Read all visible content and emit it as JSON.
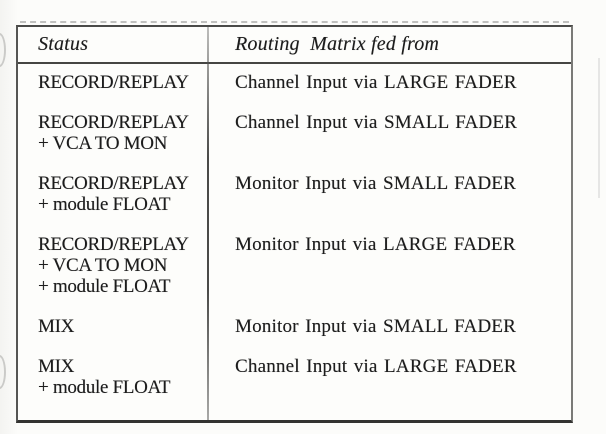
{
  "document": {
    "kind": "scanned-manual-table",
    "table": {
      "headers": {
        "status": "Status",
        "routing": "Routing  Matrix fed from"
      },
      "rows": [
        {
          "status": "RECORD/REPLAY",
          "routing": "Channel Input via LARGE FADER"
        },
        {
          "status": "RECORD/REPLAY\n+ VCA TO MON",
          "routing": "Channel Input via SMALL FADER"
        },
        {
          "status": "RECORD/REPLAY\n+ module FLOAT",
          "routing": "Monitor Input via SMALL FADER"
        },
        {
          "status": "RECORD/REPLAY\n+ VCA TO MON\n+ module FLOAT",
          "routing": "Monitor Input via LARGE FADER"
        },
        {
          "status": "MIX",
          "routing": "Monitor Input via SMALL FADER"
        },
        {
          "status": "MIX\n+ module FLOAT",
          "routing": "Channel Input via LARGE FADER"
        }
      ]
    },
    "colors": {
      "page_background": "#fcfcfa",
      "table_background": "#fdfdfb",
      "border": "#4a4a48",
      "text": "#1c1c1c",
      "artifact": "#969694"
    }
  }
}
